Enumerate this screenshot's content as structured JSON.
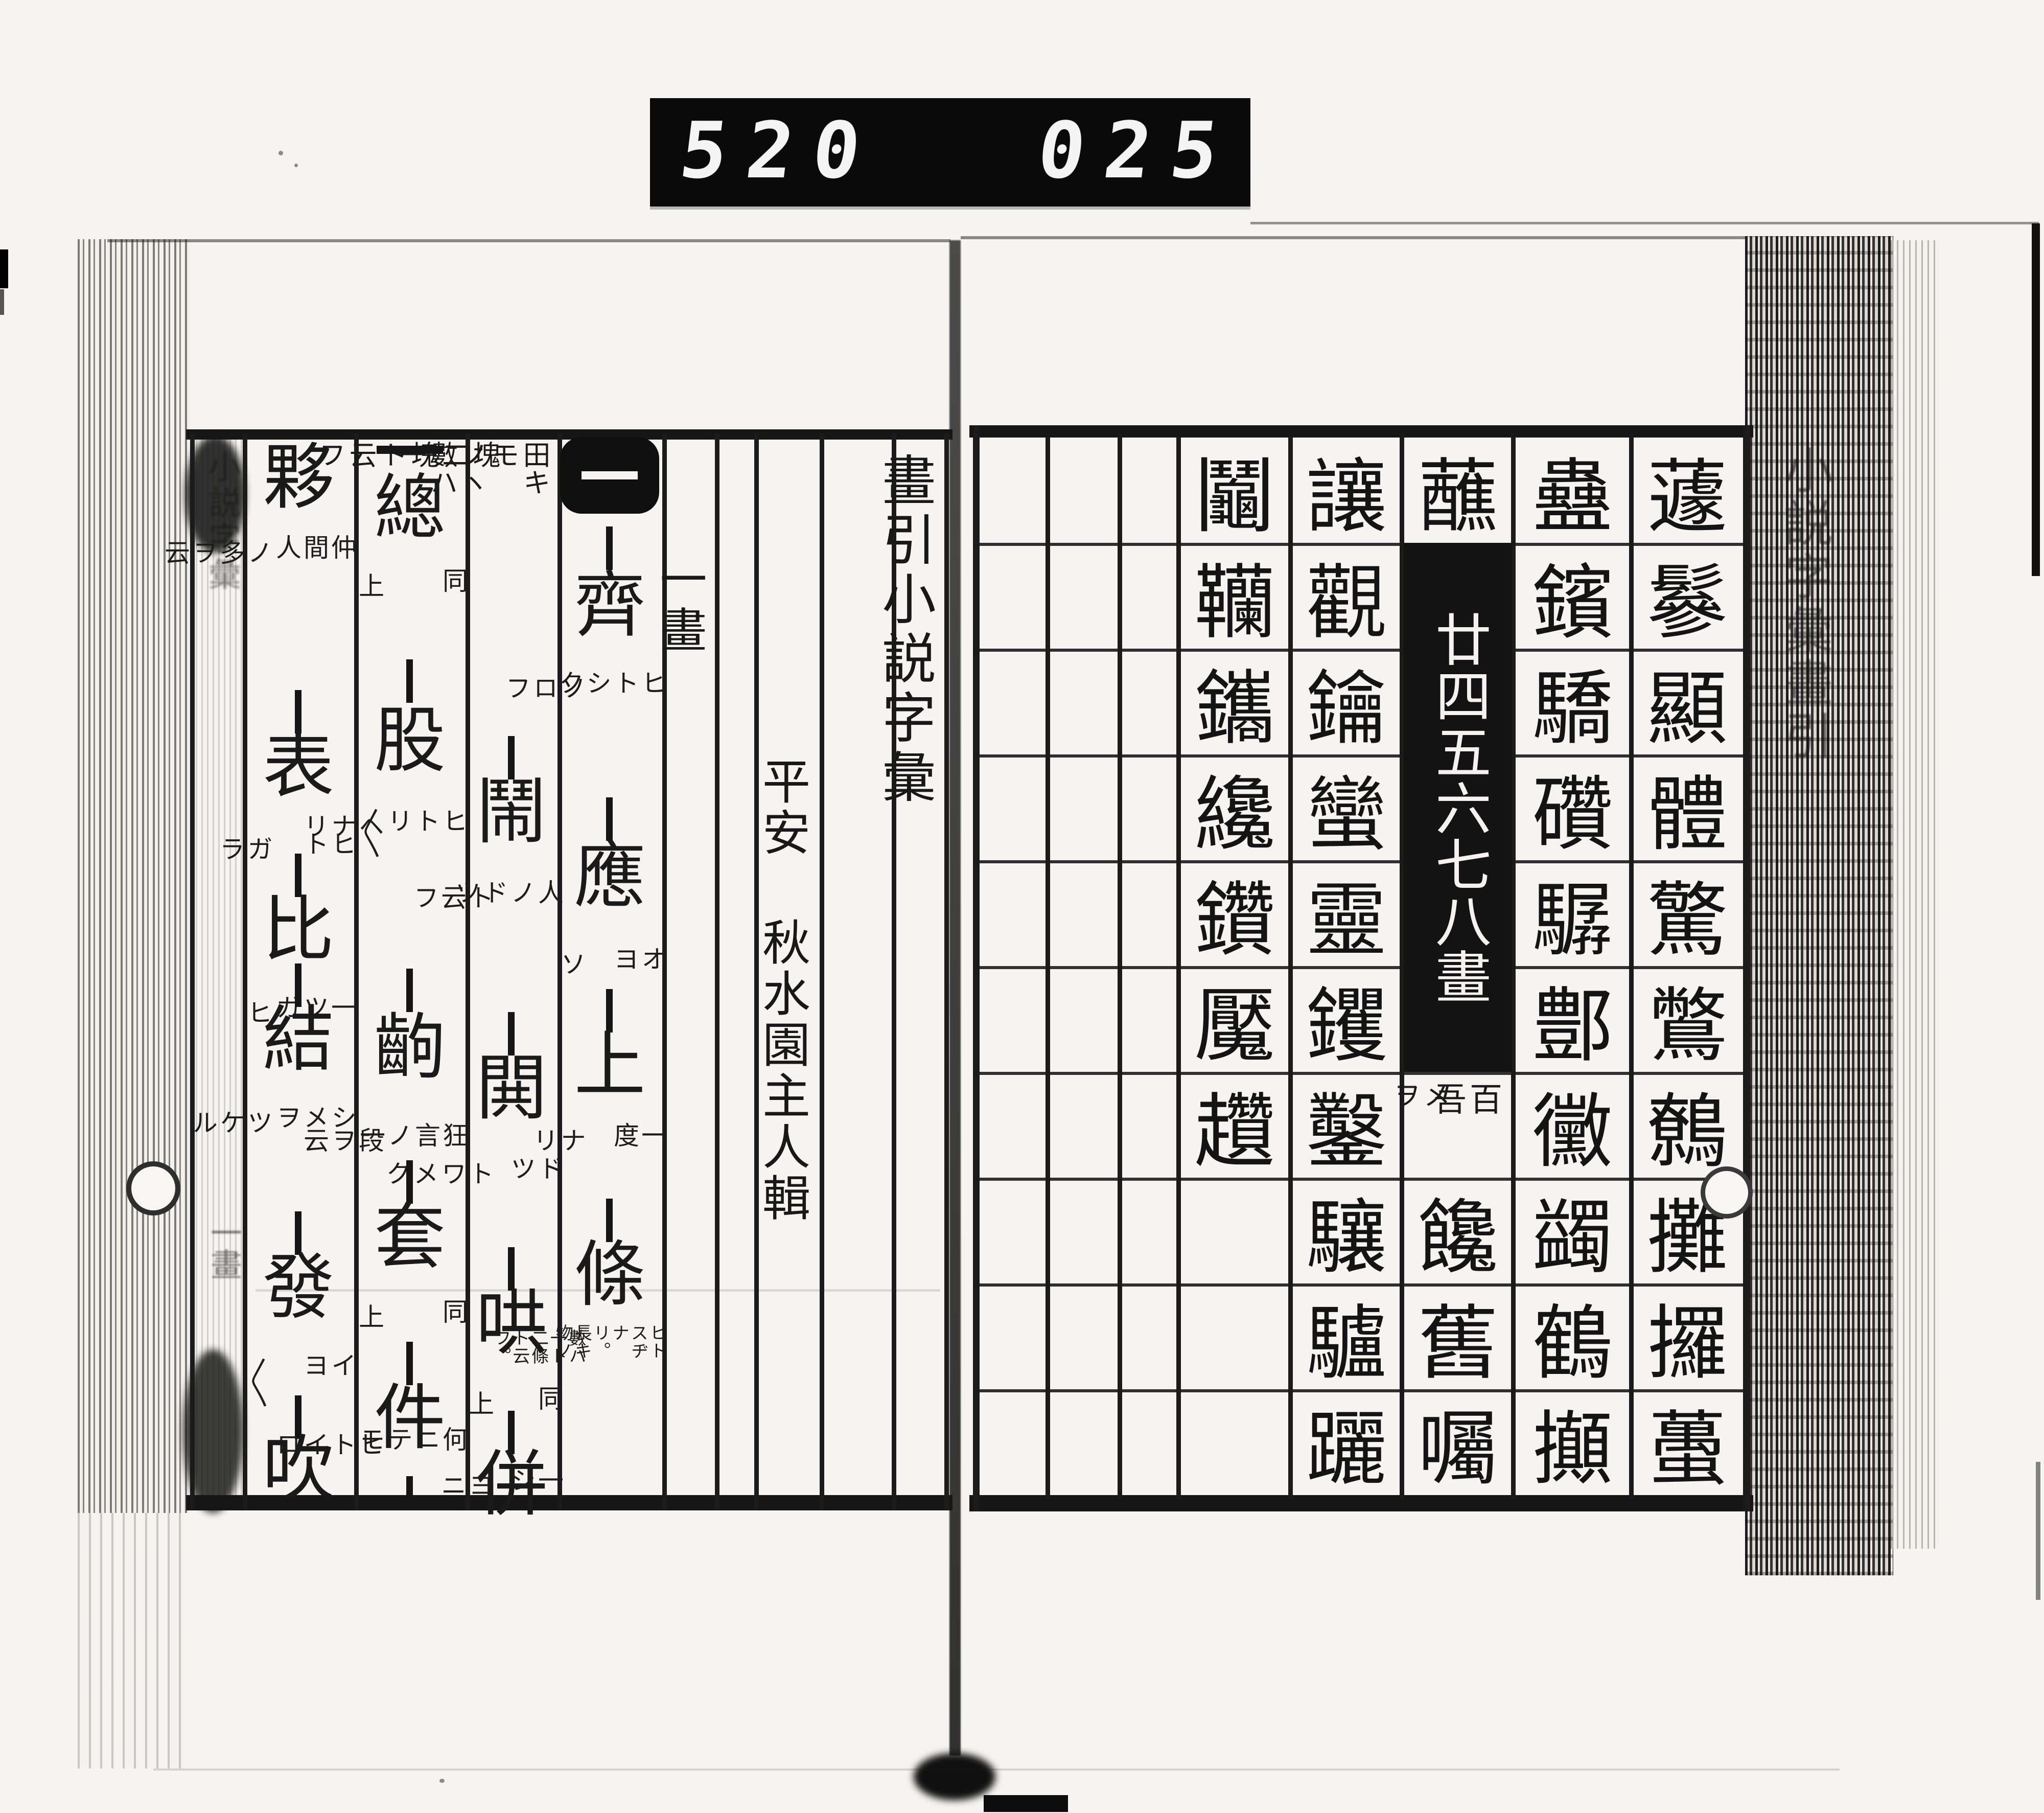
{
  "counter": {
    "left": "520",
    "right": "025."
  },
  "right_page": {
    "margin_title": "小説字彙畫引",
    "grid": {
      "columns": [
        {
          "name": "col-1",
          "cells": [
            "蘧",
            "鬖",
            "顯",
            "體",
            "驚",
            "鷩",
            "鷯",
            "攤",
            "攞",
            "蠆"
          ]
        },
        {
          "name": "col-2",
          "cells": [
            "蠱",
            "鑌",
            "驕",
            "礸",
            "驏",
            "鄷",
            "黴",
            "蠲",
            "鶴",
            "攧"
          ]
        },
        {
          "name": "col-3",
          "first": "蘸",
          "label": "廿四五六七八畫",
          "small_cell": {
            "right": "百吾",
            "left": "メヲ"
          },
          "tail": [
            "饞",
            "舊",
            "囑"
          ]
        },
        {
          "name": "col-4",
          "cells": [
            "讓",
            "觀",
            "鑰",
            "蠻",
            "靈",
            "钁",
            "鑿",
            "驤",
            "驢",
            "躧"
          ]
        },
        {
          "name": "col-5",
          "cells": [
            "鬮",
            "韊",
            "鑴",
            "纔",
            "鑽",
            "魘",
            "趲",
            "",
            "",
            ""
          ]
        },
        {
          "name": "col-6",
          "cells": [
            "",
            "",
            "",
            "",
            "",
            "",
            "",
            "",
            "",
            ""
          ]
        },
        {
          "name": "col-7",
          "cells": [
            "",
            "",
            "",
            "",
            "",
            "",
            "",
            "",
            "",
            ""
          ]
        },
        {
          "name": "col-8",
          "cells": [
            "",
            "",
            "",
            "",
            "",
            "",
            "",
            "",
            "",
            ""
          ]
        }
      ]
    }
  },
  "left_page": {
    "title": "畫引小説字彙",
    "section": "一畫",
    "author": "平安 秋水園主人輯",
    "margin_title": "小説字彙",
    "margin_section": "一畫",
    "columns": [
      {
        "name": "entries-1",
        "header": "一",
        "entries": [
          {
            "main": "齊",
            "right": "ヒトシク",
            "left": "ソロフ"
          },
          {
            "main": "應",
            "right": "オヨ",
            "left": "ソ"
          },
          {
            "main": "上",
            "right": "一度",
            "left": "ナリ"
          },
          {
            "main": "條",
            "right": "ヒトスヂナリ。長キ物ノ",
            "left": "數ハ一ト二條ト云フ。"
          }
        ]
      },
      {
        "name": "entries-2",
        "lead_note": {
          "right": "田キモノヽ數ハ一",
          "left": "塊二塊ト云フ"
        },
        "entries": [
          {
            "main": "鬧",
            "right": "人ノドツ",
            "left": "ト云フ"
          },
          {
            "main": "閧",
            "right": "ドツ",
            "left": "トワメク"
          },
          {
            "main": "哄",
            "right": "同",
            "left": "上"
          },
          {
            "main": "併",
            "right": "一シ",
            "left": "ヨニ"
          }
        ]
      },
      {
        "name": "entries-3",
        "lead": "一",
        "entries": [
          {
            "main": "總",
            "right": "同",
            "left": "上"
          },
          {
            "main": "股",
            "right": "ヒトリ〱",
            "left": "ヘナリ"
          },
          {
            "main": "齣",
            "right": "狂言ノ一",
            "left": "段ヲ云"
          },
          {
            "main": "套",
            "right": "同",
            "left": "上"
          },
          {
            "main": "件",
            "right": "何ニテモ",
            "left": "ヒトイロ"
          }
        ]
      },
      {
        "name": "entries-4",
        "entries": [
          {
            "main": "夥",
            "right": "仲間人",
            "left": "ノ多ヲ云"
          },
          {
            "main": "表",
            "right": "ヒト",
            "left": "ガラ"
          },
          {
            "main": "比",
            "right": "一ツガ",
            "left": "ヒ"
          },
          {
            "main": "結",
            "right": "シメヲ",
            "left": "ツケル"
          },
          {
            "main": "發",
            "right": "イヨ",
            "left": "〱"
          },
          {
            "main": "吹",
            "right": "",
            "left": ""
          }
        ]
      }
    ]
  }
}
